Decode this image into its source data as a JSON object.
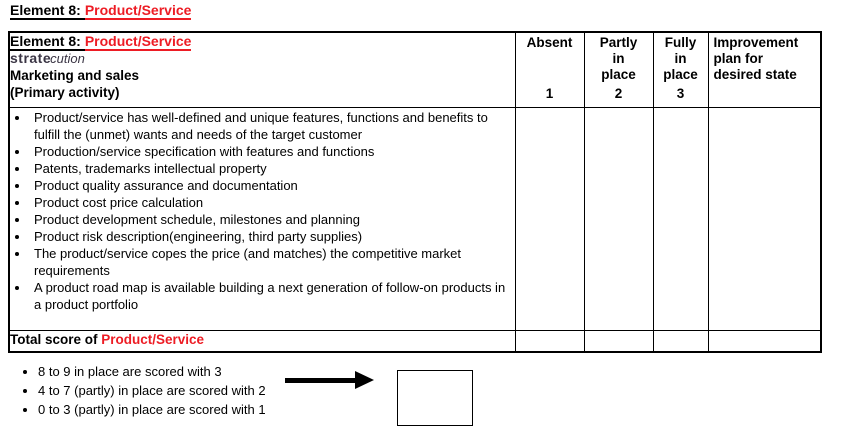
{
  "colors": {
    "accent_red": "#ed1c24",
    "logo_color": "#3a3544",
    "border": "#000000"
  },
  "page_title": {
    "prefix": "Element 8:",
    "highlight": "Product/Service"
  },
  "table": {
    "header": {
      "element_cell": {
        "title_prefix": "Element 8:",
        "title_highlight": "Product/Service",
        "logo_part1": "strate",
        "logo_part2": "cution",
        "category_line": "Marketing and sales",
        "activity_line": "(Primary activity)"
      },
      "columns": [
        {
          "label": "Absent",
          "number": "1"
        },
        {
          "label": "Partly\nin\nplace",
          "number": "2"
        },
        {
          "label": "Fully\nin\nplace",
          "number": "3"
        },
        {
          "label": "Improvement\nplan for\ndesired state",
          "number": ""
        }
      ]
    },
    "items": [
      "Product/service has well-defined and unique features, functions and benefits to fulfill the (unmet) wants and needs of the target customer",
      "Production/service specification with features and functions",
      "Patents, trademarks intellectual property",
      "Product quality assurance and documentation",
      "Product cost price calculation",
      "Product development schedule, milestones and planning",
      "Product risk description(engineering, third party supplies)",
      "The product/service copes the price (and matches) the competitive market requirements",
      "A product road map is available building a next generation of follow-on products in a product portfolio"
    ],
    "total_row": {
      "prefix": "Total score of ",
      "highlight": "Product/Service"
    }
  },
  "scoring_legend": {
    "items": [
      "8 to 9 in place are scored with 3",
      "4 to 7 (partly) in place are scored with 2",
      "0 to 3 (partly) in place are scored with 1"
    ]
  }
}
